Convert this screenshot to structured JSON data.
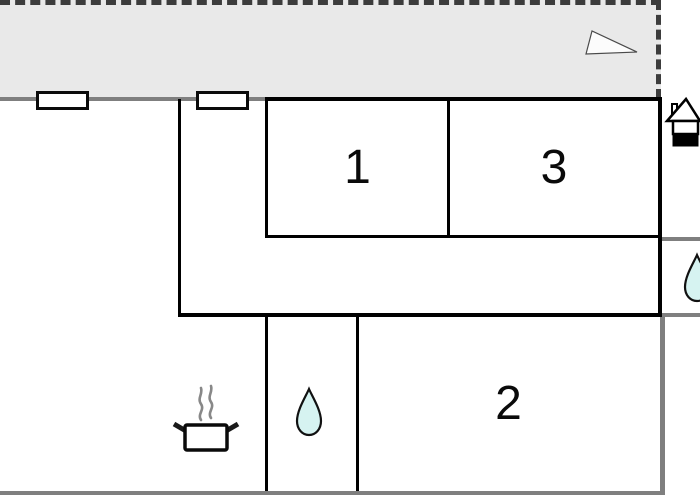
{
  "floorplan": {
    "rooms": [
      {
        "name": "room-1",
        "label": "1"
      },
      {
        "name": "room-3",
        "label": "3"
      },
      {
        "name": "room-2",
        "label": "2"
      }
    ],
    "icons": {
      "triangle_marker": "triangle-marker-icon",
      "house_entrance": "house-entrance-icon",
      "water_drop_middle": "water-drop-icon",
      "water_drop_right": "water-drop-icon",
      "cooking_pot": "cooking-pot-icon"
    },
    "colors": {
      "canvas_bg": "#ffffff",
      "terrace_fill": "#e9e9e9",
      "boundary_dash": "#3c3c3c",
      "wall_gray": "#7f7f7f",
      "line_black": "#000000",
      "water_drop_fill": "#d6f3f1",
      "steam_gray": "#888888"
    }
  }
}
